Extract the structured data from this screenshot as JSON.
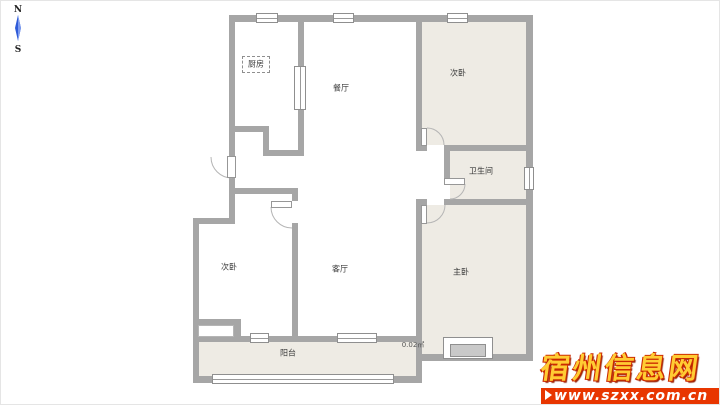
{
  "compass": {
    "north_label": "N",
    "south_label": "S",
    "needle_color": "#2f5bd8"
  },
  "floorplan": {
    "wall_color": "#a6a6a6",
    "room_fill_color": "#eeebe4",
    "labels": {
      "kitchen": "厨房",
      "dining": "餐厅",
      "bedroom_northeast": "次卧",
      "bathroom": "卫生间",
      "bedroom_southwest": "次卧",
      "living": "客厅",
      "master_bedroom": "主卧",
      "balcony": "阳台",
      "area_note": "0.02㎡"
    }
  },
  "watermark": {
    "site_name": "宿州信息网",
    "site_url": "www.szxx.com.cn",
    "title_color": "#ffcc33",
    "title_shadow_color": "#cc2a00",
    "banner_color": "#e83600",
    "banner_text_color": "#ffffff"
  }
}
